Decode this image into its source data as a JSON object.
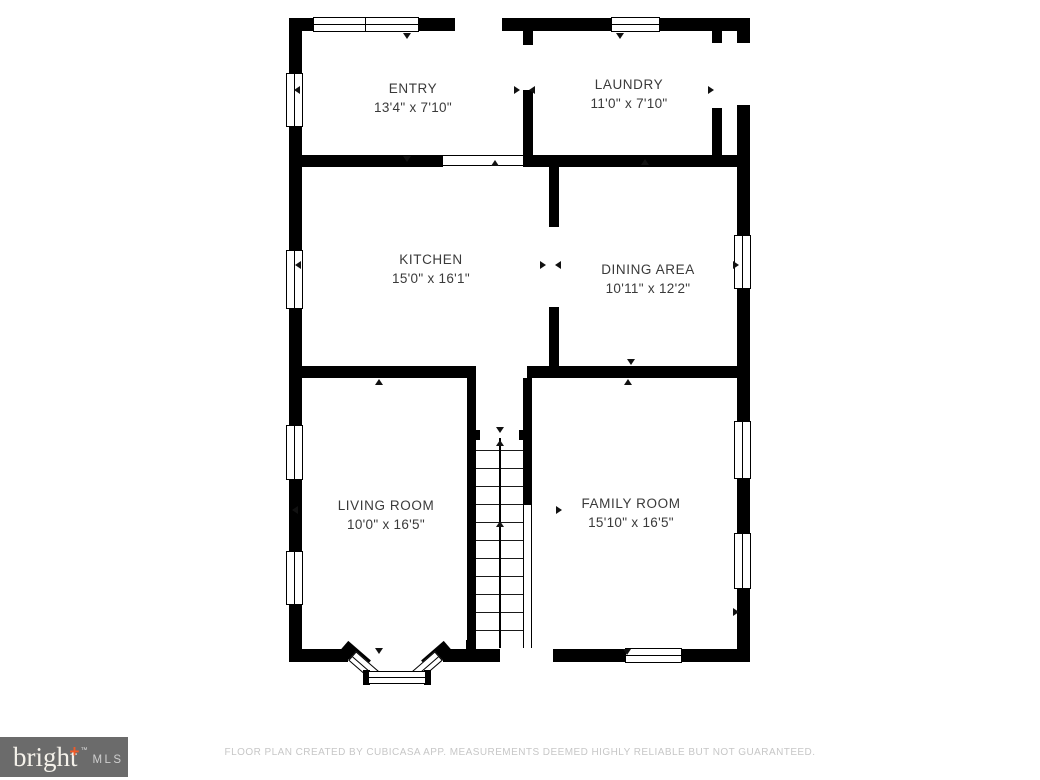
{
  "rooms": [
    {
      "id": "entry",
      "name": "ENTRY",
      "dims": "13'4\" x 7'10\""
    },
    {
      "id": "laundry",
      "name": "LAUNDRY",
      "dims": "11'0\" x 7'10\""
    },
    {
      "id": "kitchen",
      "name": "KITCHEN",
      "dims": "15'0\" x 16'1\""
    },
    {
      "id": "dining",
      "name": "DINING AREA",
      "dims": "10'11\" x 12'2\""
    },
    {
      "id": "living",
      "name": "LIVING ROOM",
      "dims": "10'0\" x 16'5\""
    },
    {
      "id": "family",
      "name": "FAMILY ROOM",
      "dims": "15'10\" x 16'5\""
    }
  ],
  "footer": {
    "disclaimer": "FLOOR PLAN CREATED BY CUBICASA APP. MEASUREMENTS DEEMED HIGHLY RELIABLE BUT NOT GUARANTEED."
  },
  "logo": {
    "brand": "bright",
    "plus": "+",
    "tm": "™",
    "suffix": "MLS"
  },
  "colors": {
    "wall": "#000000",
    "label_text": "#3a3a3a",
    "footer_text": "#c7c7c7",
    "logo_background": "#6b6b6b",
    "logo_plus": "#f05a28"
  }
}
